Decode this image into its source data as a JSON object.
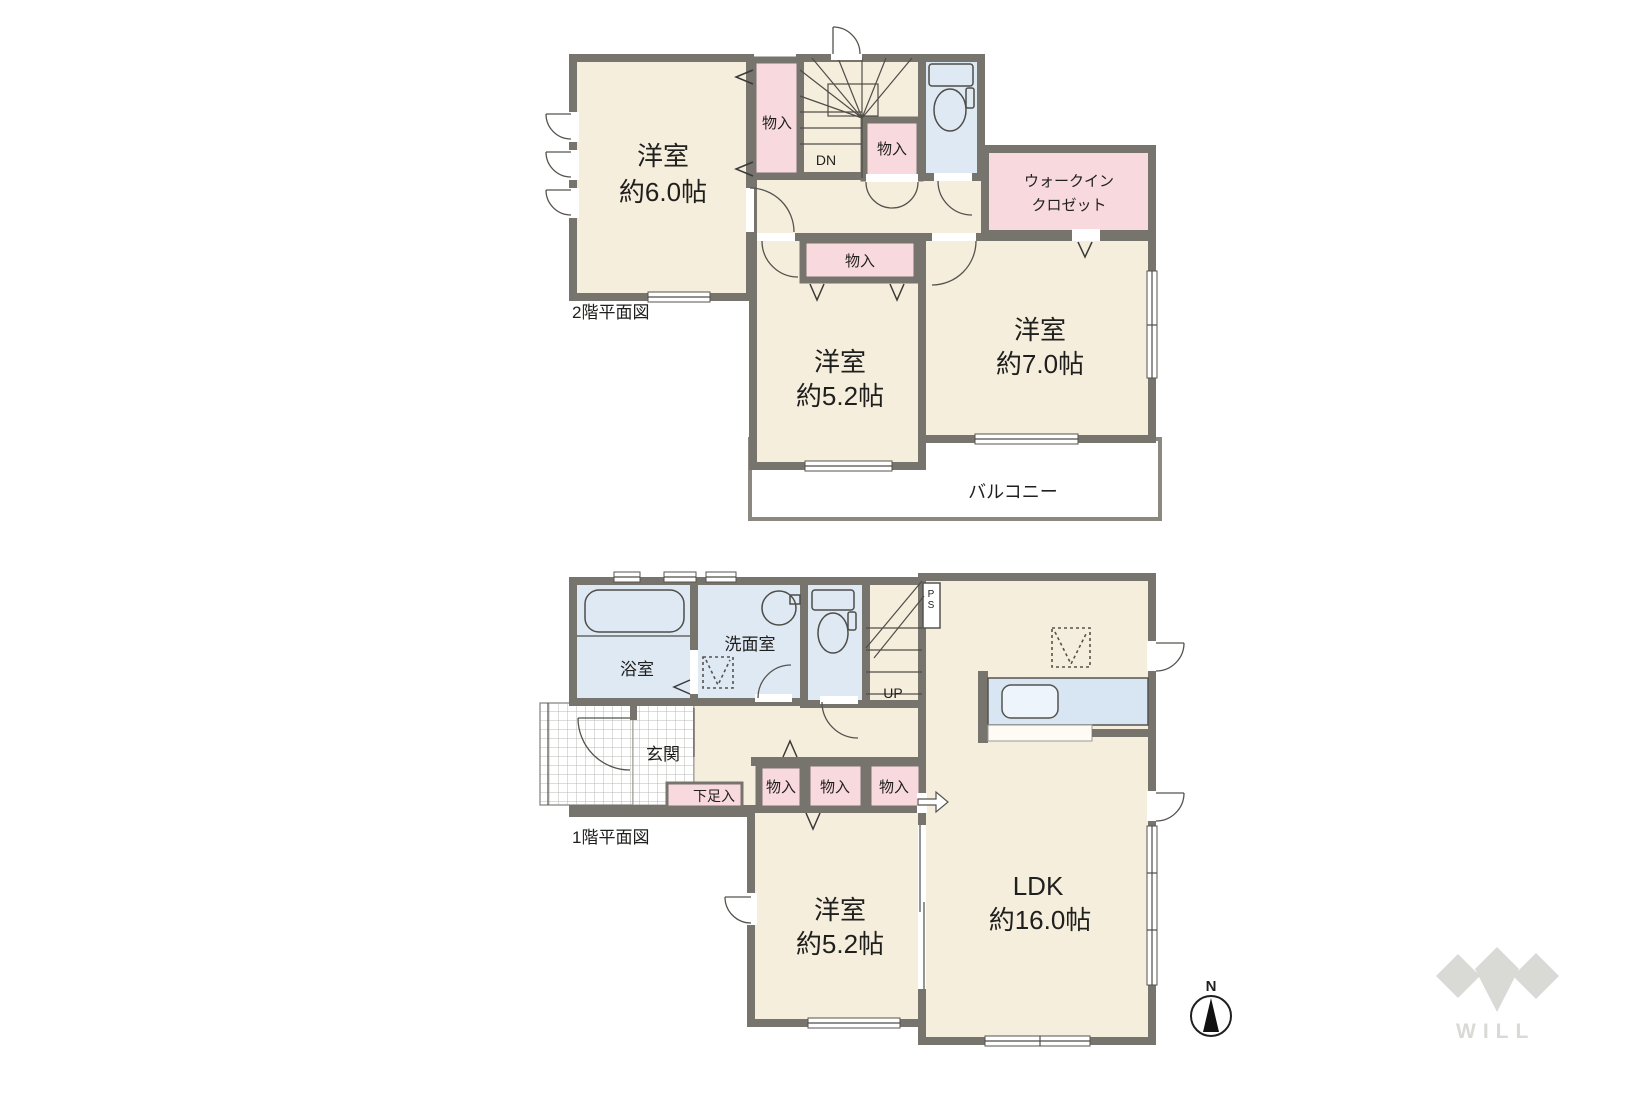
{
  "floor2": {
    "title": "2階平面図",
    "bedroom6": {
      "name": "洋室",
      "size": "約6.0帖"
    },
    "bedroom52": {
      "name": "洋室",
      "size": "約5.2帖"
    },
    "bedroom7": {
      "name": "洋室",
      "size": "約7.0帖"
    },
    "wic": {
      "line1": "ウォークイン",
      "line2": "クロゼット"
    },
    "closet_a": "物入",
    "closet_b": "物入",
    "closet_c": "物入",
    "stairs_direction": "DN",
    "balcony": "バルコニー"
  },
  "floor1": {
    "title": "1階平面図",
    "bath": "浴室",
    "washroom": "洗面室",
    "entrance": "玄関",
    "shoe_closet": "下足入",
    "closet_1": "物入",
    "closet_2": "物入",
    "closet_3": "物入",
    "stairs_direction": "UP",
    "pipe_space": "PS",
    "bedroom52": {
      "name": "洋室",
      "size": "約5.2帖"
    },
    "ldk": {
      "name": "LDK",
      "size": "約16.0帖"
    }
  },
  "compass": {
    "north": "N"
  },
  "logo": {
    "text": "WILL"
  },
  "colors": {
    "floor_beige": "#f6eedd",
    "closet_pink": "#f8d9de",
    "wet_area_blue": "#dfe9f4",
    "wall_gray": "#76746c",
    "balcony_white": "#ffffff",
    "logo_gray": "#d9d9d6"
  }
}
